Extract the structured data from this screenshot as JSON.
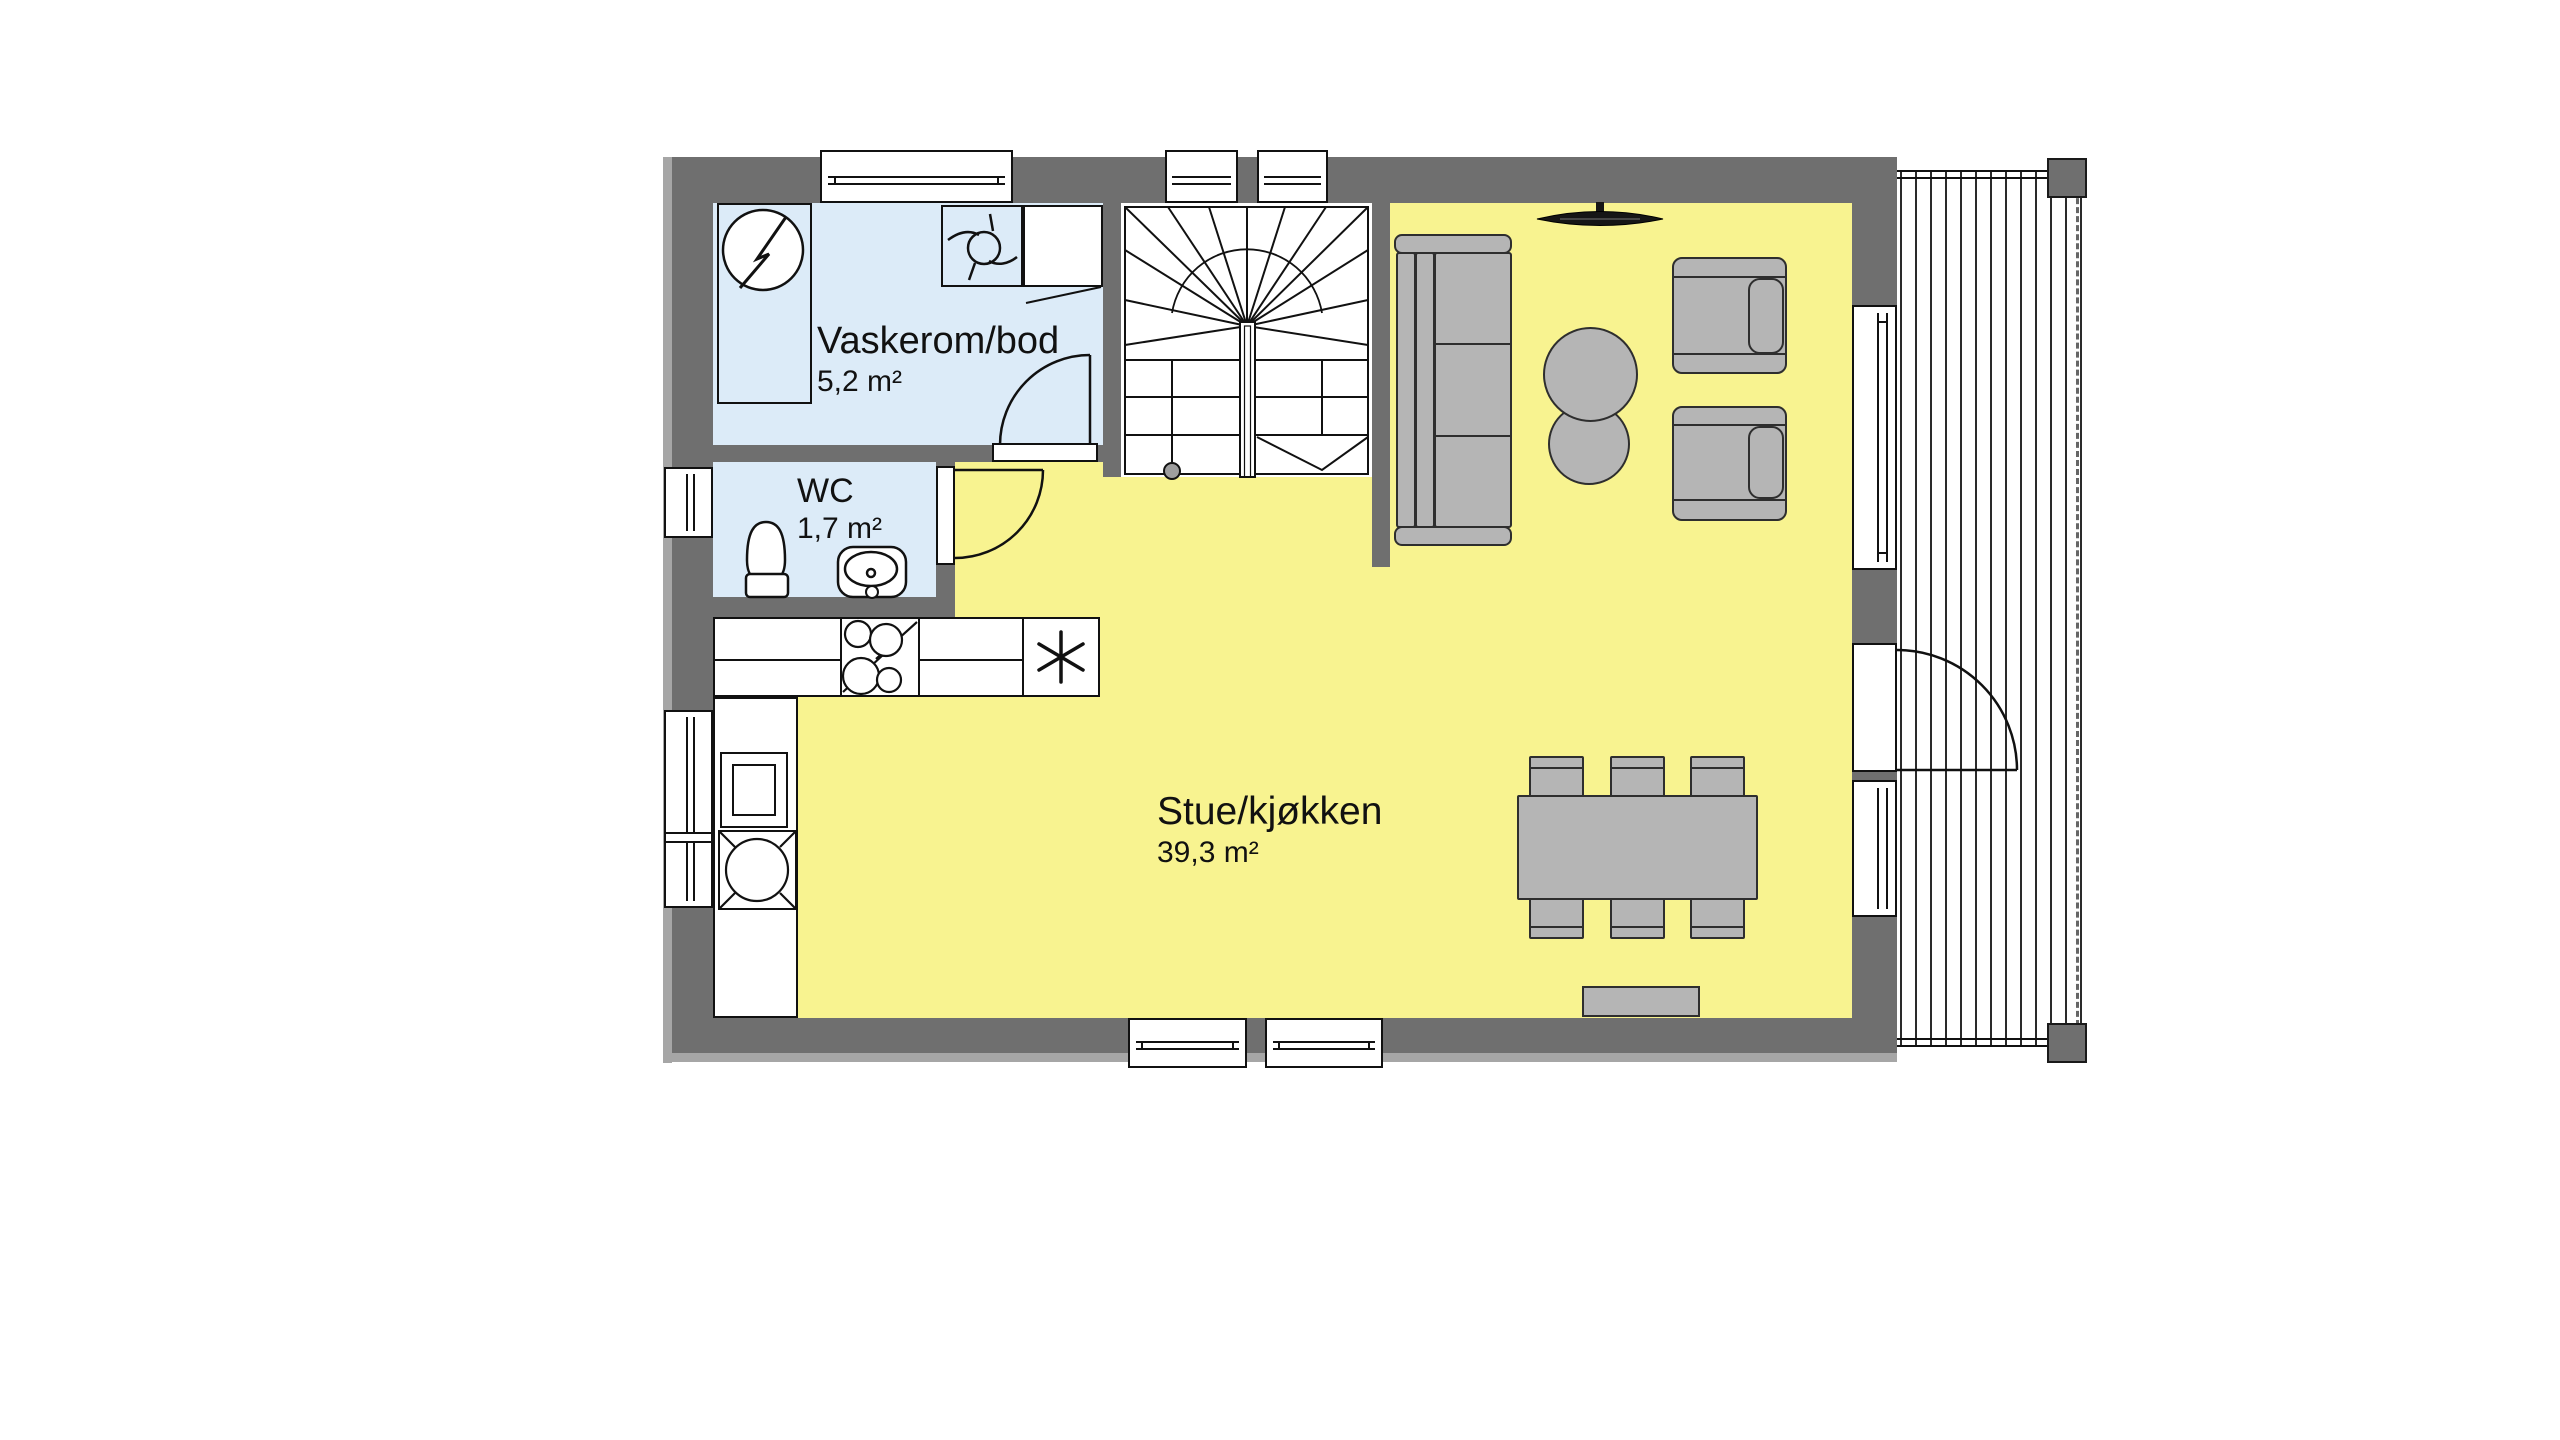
{
  "rooms": {
    "vaskerom": {
      "name": "Vaskerom/bod",
      "area": "5,2 m²"
    },
    "wc": {
      "name": "WC",
      "area": "1,7 m²"
    },
    "stue": {
      "name": "Stue/kjøkken",
      "area": "39,3 m²"
    }
  },
  "colors": {
    "floor_living": "#f8f390",
    "floor_wet": "#dcebf8",
    "wall": "#6f6f6f",
    "furniture": "#b5b5b5",
    "line": "#111111"
  },
  "symbols": {
    "electrical_panel": "circle-lightning-icon",
    "washer_trap": "drain-trap-icon",
    "freezer": "asterisk-icon",
    "cooktop": "four-burner-stove-icon",
    "stair_direction": "arrow-v-icon"
  }
}
